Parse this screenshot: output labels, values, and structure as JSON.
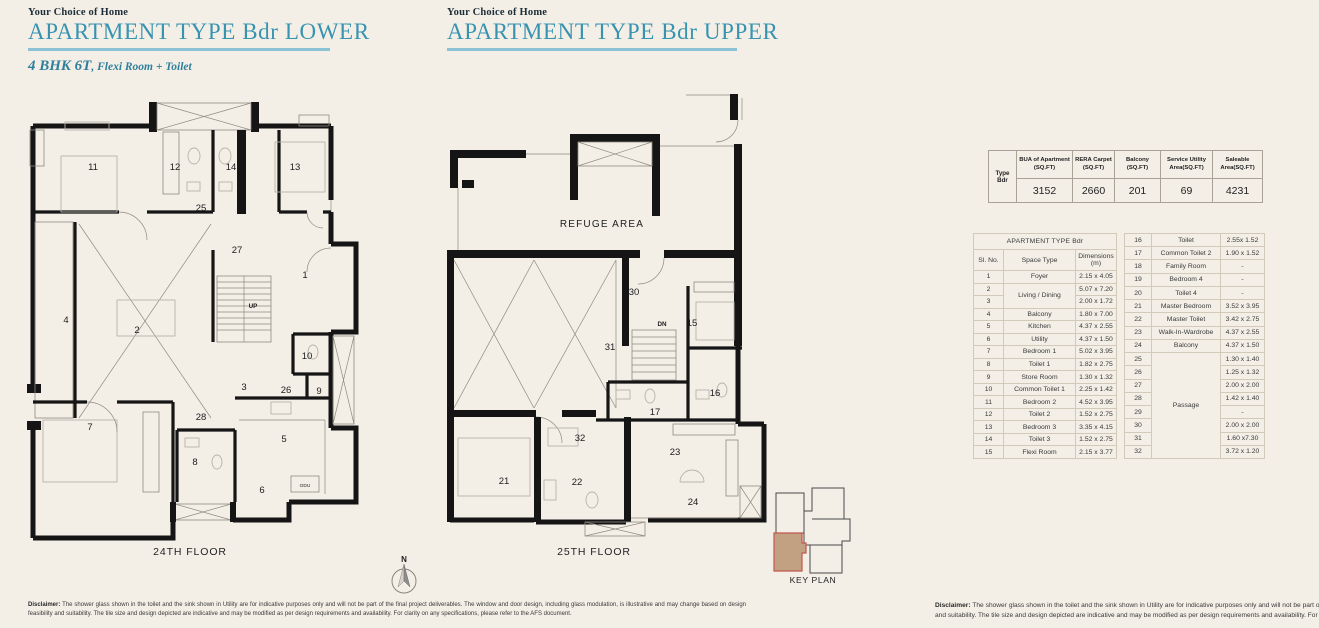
{
  "headers": {
    "lower": {
      "eyebrow": "Your Choice of Home",
      "title": "APARTMENT TYPE Bdr LOWER",
      "subtitle_bold": "4 BHK 6T",
      "subtitle_rest": ", Flexi Room + Toilet"
    },
    "upper": {
      "eyebrow": "Your Choice of Home",
      "title": "APARTMENT TYPE Bdr UPPER"
    }
  },
  "colors": {
    "accent_teal": "#3793b0",
    "underline_blue": "#8cc2d6",
    "wall_black": "#151515",
    "keyplan_fill": "#c2a183",
    "keyplan_outline": "#c2574b",
    "background": "#f3efe7"
  },
  "plan_lower": {
    "caption": "24TH FLOOR",
    "labels": [
      {
        "t": "11",
        "x": 68,
        "y": 80,
        "c": "num"
      },
      {
        "t": "12",
        "x": 150,
        "y": 80,
        "c": "num"
      },
      {
        "t": "14",
        "x": 206,
        "y": 80,
        "c": "num"
      },
      {
        "t": "13",
        "x": 270,
        "y": 80,
        "c": "num"
      },
      {
        "t": "25",
        "x": 176,
        "y": 121,
        "c": "num"
      },
      {
        "t": "27",
        "x": 212,
        "y": 163,
        "c": "num"
      },
      {
        "t": "1",
        "x": 280,
        "y": 188,
        "c": "num"
      },
      {
        "t": "UP",
        "x": 228,
        "y": 218,
        "c": "small"
      },
      {
        "t": "4",
        "x": 41,
        "y": 233,
        "c": "num"
      },
      {
        "t": "2",
        "x": 112,
        "y": 243,
        "c": "num"
      },
      {
        "t": "10",
        "x": 282,
        "y": 269,
        "c": "num"
      },
      {
        "t": "3",
        "x": 219,
        "y": 300,
        "c": "num"
      },
      {
        "t": "26",
        "x": 261,
        "y": 303,
        "c": "num"
      },
      {
        "t": "9",
        "x": 294,
        "y": 304,
        "c": "num"
      },
      {
        "t": "28",
        "x": 176,
        "y": 330,
        "c": "num"
      },
      {
        "t": "7",
        "x": 65,
        "y": 340,
        "c": "num"
      },
      {
        "t": "5",
        "x": 259,
        "y": 352,
        "c": "num"
      },
      {
        "t": "8",
        "x": 170,
        "y": 375,
        "c": "num"
      },
      {
        "t": "6",
        "x": 237,
        "y": 403,
        "c": "num"
      },
      {
        "t": "ODU",
        "x": 280,
        "y": 397,
        "c": "tiny"
      }
    ]
  },
  "plan_upper": {
    "caption": "25TH FLOOR",
    "labels": [
      {
        "t": "REFUGE AREA",
        "x": 162,
        "y": 137,
        "c": "refuge"
      },
      {
        "t": "30",
        "x": 194,
        "y": 205,
        "c": "num"
      },
      {
        "t": "15",
        "x": 252,
        "y": 236,
        "c": "num"
      },
      {
        "t": "DN",
        "x": 222,
        "y": 236,
        "c": "small"
      },
      {
        "t": "31",
        "x": 170,
        "y": 260,
        "c": "num"
      },
      {
        "t": "16",
        "x": 275,
        "y": 306,
        "c": "num"
      },
      {
        "t": "17",
        "x": 215,
        "y": 325,
        "c": "num"
      },
      {
        "t": "32",
        "x": 140,
        "y": 351,
        "c": "num"
      },
      {
        "t": "23",
        "x": 235,
        "y": 365,
        "c": "num"
      },
      {
        "t": "21",
        "x": 64,
        "y": 394,
        "c": "num"
      },
      {
        "t": "22",
        "x": 137,
        "y": 395,
        "c": "num"
      },
      {
        "t": "24",
        "x": 253,
        "y": 415,
        "c": "num"
      }
    ]
  },
  "compass": {
    "north_label": "N"
  },
  "key_plan": {
    "caption": "KEY PLAN"
  },
  "summary_table": {
    "row_header": "Type Bdr",
    "columns": [
      "BUA of Apartment (SQ.FT)",
      "RERA Carpet (SQ.FT)",
      "Balcony (SQ.FT)",
      "Service Utility Area(SQ.FT)",
      "Saleable Area(SQ.FT)"
    ],
    "values": [
      "3152",
      "2660",
      "201",
      "69",
      "4231"
    ]
  },
  "room_table": {
    "title": "APARTMENT TYPE Bdr",
    "headers": {
      "sl": "Sl. No.",
      "space": "Space Type",
      "dim": "Dimensions (m)"
    },
    "left_rows": [
      {
        "no": "1",
        "space": "Foyer",
        "dim": "2.15 x 4.05"
      },
      {
        "no": "2",
        "space": "Living / Dining",
        "space_span": 2,
        "dim": "5.07 x 7.20"
      },
      {
        "no": "3",
        "dim": "2.00 x 1.72"
      },
      {
        "no": "4",
        "space": "Balcony",
        "dim": "1.80 x 7.00"
      },
      {
        "no": "5",
        "space": "Kitchen",
        "dim": "4.37 x 2.55"
      },
      {
        "no": "6",
        "space": "Utility",
        "dim": "4.37 x 1.50"
      },
      {
        "no": "7",
        "space": "Bedroom 1",
        "dim": "5.02 x 3.95"
      },
      {
        "no": "8",
        "space": "Toilet 1",
        "dim": "1.82 x 2.75"
      },
      {
        "no": "9",
        "space": "Store Room",
        "dim": "1.30 x 1.32"
      },
      {
        "no": "10",
        "space": "Common Toilet 1",
        "dim": "2.25 x 1.42"
      },
      {
        "no": "11",
        "space": "Bedroom 2",
        "dim": "4.52 x 3.95"
      },
      {
        "no": "12",
        "space": "Toilet 2",
        "dim": "1.52 x 2.75"
      },
      {
        "no": "13",
        "space": "Bedroom 3",
        "dim": "3.35 x 4.15"
      },
      {
        "no": "14",
        "space": "Toilet 3",
        "dim": "1.52 x 2.75"
      },
      {
        "no": "15",
        "space": "Flexi Room",
        "dim": "2.15 x 3.77"
      }
    ],
    "right_rows": [
      {
        "no": "16",
        "space": "Toilet",
        "dim": "2.55x 1.52"
      },
      {
        "no": "17",
        "space": "Common Toilet 2",
        "dim": "1.90 x 1.52"
      },
      {
        "no": "18",
        "space": "Family Room",
        "dim": "-"
      },
      {
        "no": "19",
        "space": "Bedroom 4",
        "dim": "-"
      },
      {
        "no": "20",
        "space": "Toilet 4",
        "dim": "-"
      },
      {
        "no": "21",
        "space": "Master Bedroom",
        "dim": "3.52 x 3.95"
      },
      {
        "no": "22",
        "space": "Master Toilet",
        "dim": "3.42 x 2.75"
      },
      {
        "no": "23",
        "space": "Walk-In-Wardrobe",
        "dim": "4.37 x 2.55"
      },
      {
        "no": "24",
        "space": "Balcony",
        "dim": "4.37 x 1.50"
      },
      {
        "no": "25",
        "space": "Passage",
        "space_span": 8,
        "dim": "1.30 x 1.40"
      },
      {
        "no": "26",
        "dim": "1.25 x 1.32"
      },
      {
        "no": "27",
        "dim": "2.00 x 2.00"
      },
      {
        "no": "28",
        "dim": "1.42 x 1.40"
      },
      {
        "no": "29",
        "dim": "-"
      },
      {
        "no": "30",
        "dim": "2.00 x 2.00"
      },
      {
        "no": "31",
        "dim": "1.60 x7.30"
      },
      {
        "no": "32",
        "dim": "3.72 x 1.20"
      }
    ]
  },
  "disclaimer": {
    "label": "Disclaimer:",
    "text": " The shower glass shown in the toilet and the sink shown in Utility are for indicative purposes only and will not be part of the final project deliverables. The window and door design, including glass modulation, is illustrative and may change based on design feasibility and suitability. The tile size and design depicted are indicative and may be modified as per design requirements and availability. For clarity on any specifications, please refer to the AFS document."
  }
}
